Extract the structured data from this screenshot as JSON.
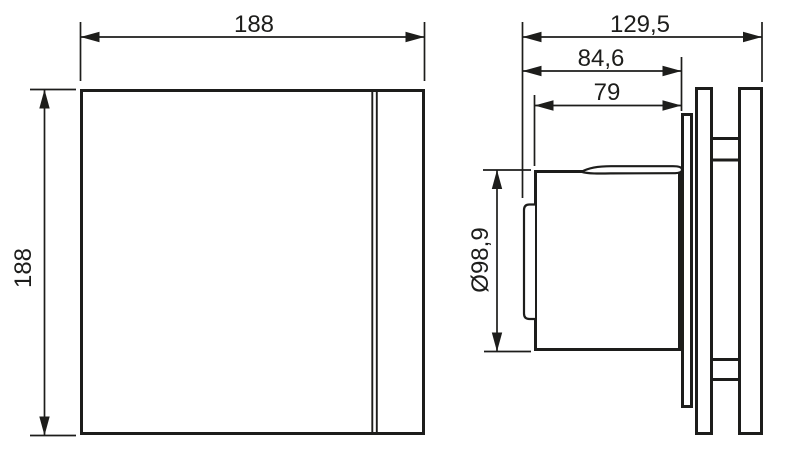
{
  "diagram": {
    "labels": {
      "front_width": "188",
      "front_height": "188",
      "total_depth": "129,5",
      "body_depth": "84,6",
      "duct_length": "79",
      "duct_diameter": "Ø98,9"
    },
    "colors": {
      "line": "#1d1d1b",
      "background": "#ffffff"
    }
  }
}
